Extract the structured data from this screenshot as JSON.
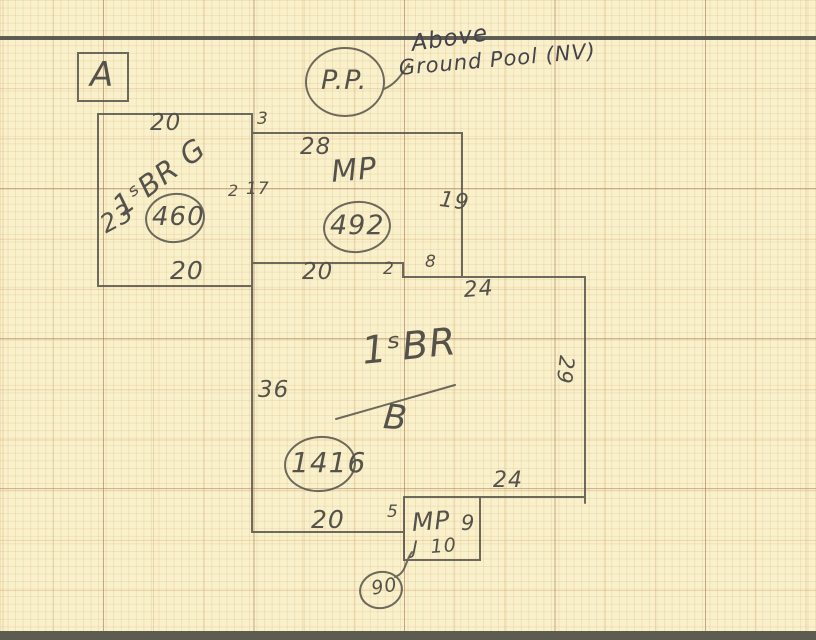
{
  "sketch": {
    "zone_label": "A",
    "pool": {
      "circle": "P.P.",
      "note_line1": "Above",
      "note_line2": "Ground Pool (NV)"
    },
    "garage": {
      "top_dim": "20",
      "offset_dim": "3",
      "name": "1ˢBR G",
      "left_dim": "23",
      "area": "460",
      "bottom_dim": "20"
    },
    "mp_upper": {
      "top_dim": "28",
      "name": "MP",
      "area": "492",
      "left_outer_dim": "2",
      "left_dim": "17",
      "right_dim": "19"
    },
    "main_house": {
      "top_dim": "20",
      "step_dim": "2",
      "jog_dim": "8",
      "upper_right_dim": "24",
      "left_dim": "36",
      "name_numerator": "1ˢBR",
      "name_denominator": "B",
      "area": "1416",
      "right_dim": "29",
      "lower_right_dim": "24",
      "bottom_dim": "20",
      "bottom_step_dim": "5"
    },
    "mp_lower": {
      "name": "MP",
      "right_dim": "9",
      "hook": "J",
      "bottom_dim": "10",
      "area": "90"
    }
  },
  "colors": {
    "paper": "#f9f1cc",
    "pencil": "#5a574d",
    "dark_note": "#45434b",
    "grid_fine": "#eedcb5",
    "grid_heavy": "#b99a7e"
  }
}
